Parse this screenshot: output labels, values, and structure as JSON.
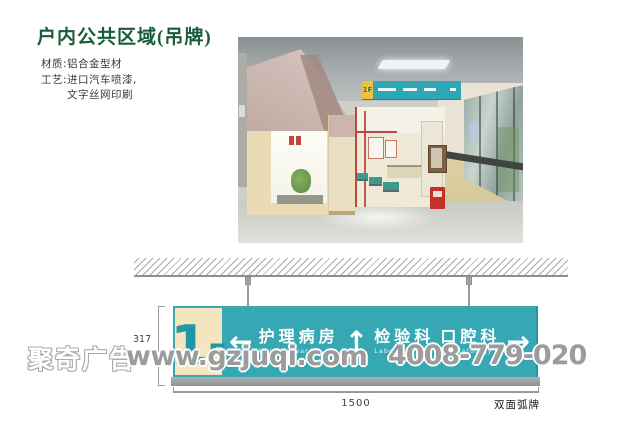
{
  "page": {
    "title": "户内公共区域(吊牌)",
    "specs": [
      "材质:铝合金型材",
      "工艺:进口汽车喷漆,",
      "文字丝网印刷"
    ]
  },
  "photo": {
    "sign": {
      "floor": "1F"
    }
  },
  "drawing": {
    "floor_big": "1",
    "floor_small": "F",
    "arrow_left": "←",
    "arrow_up": "↑",
    "arrow_right": "→",
    "entries": [
      {
        "arrow": "left",
        "zh": "护理病房",
        "en": "Nursing ward"
      },
      {
        "arrow": "up",
        "zh": "检验科",
        "en": "Laboratory"
      },
      {
        "arrow": "right",
        "zh": "口腔科",
        "en": "Stomatology"
      }
    ],
    "dim_height": "317",
    "dim_width": "1500",
    "type_label": "双面弧牌",
    "colors": {
      "teal": "#35A8B4",
      "cream": "#F3E5BD",
      "base_gray": "#9BA0A0",
      "floor_text": "#2196A6",
      "title_green": "#1A5C38"
    }
  },
  "watermark": {
    "brand": "聚奇广告",
    "url": "www.gzjuqi.com",
    "phone": "4008-779-020",
    "color": "#9C9C9C"
  }
}
